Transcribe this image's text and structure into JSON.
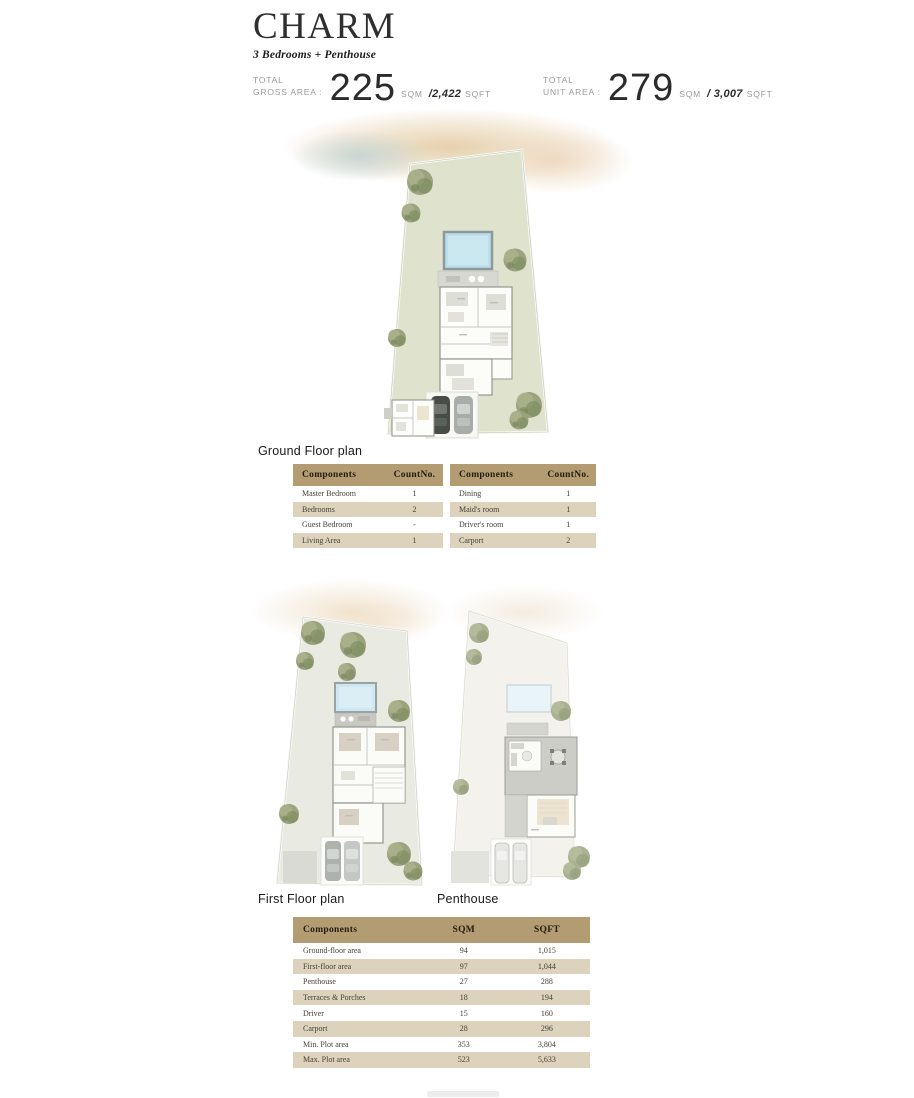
{
  "header": {
    "title": "CHARM",
    "subtitle": "3 Bedrooms + Penthouse"
  },
  "stats": [
    {
      "label_line1": "TOTAL",
      "label_line2": "GROSS AREA :",
      "value": "225",
      "unit1": "SQM",
      "alt": "/2,422",
      "unit2": "SQFT"
    },
    {
      "label_line1": "TOTAL",
      "label_line2": "UNIT AREA :",
      "value": "279",
      "unit1": "SQM",
      "alt": "/ 3,007",
      "unit2": "SQFT"
    }
  ],
  "plans": {
    "ground": {
      "label": "Ground Floor plan"
    },
    "first": {
      "label": "First Floor plan"
    },
    "penthouse": {
      "label": "Penthouse"
    }
  },
  "component_tables": [
    {
      "headers": [
        "Components",
        "CountNo."
      ],
      "rows": [
        [
          "Master Bedroom",
          "1"
        ],
        [
          "Bedrooms",
          "2"
        ],
        [
          "Guest Bedroom",
          "-"
        ],
        [
          "Living Area",
          "1"
        ]
      ]
    },
    {
      "headers": [
        "Components",
        "CountNo."
      ],
      "rows": [
        [
          "Dining",
          "1"
        ],
        [
          "Maid's room",
          "1"
        ],
        [
          "Driver's room",
          "1"
        ],
        [
          "Carport",
          "2"
        ]
      ]
    }
  ],
  "area_table": {
    "headers": [
      "Components",
      "SQM",
      "SQFT"
    ],
    "rows": [
      [
        "Ground-floor area",
        "94",
        "1,015"
      ],
      [
        "First-floor area",
        "97",
        "1,044"
      ],
      [
        "Penthouse",
        "27",
        "288"
      ],
      [
        "Terraces & Porches",
        "18",
        "194"
      ],
      [
        "Driver",
        "15",
        "160"
      ],
      [
        "Carport",
        "28",
        "296"
      ],
      [
        "Min. Plot area",
        "353",
        "3,804"
      ],
      [
        "Max. Plot area",
        "523",
        "5,633"
      ]
    ]
  },
  "colors": {
    "table_header_bg": "#b39c72",
    "table_row_alt_bg": "#ddd2bb",
    "plot_green": "#dfe3cd",
    "plot_gray": "#e9eae1",
    "plot_light": "#f3f2ec",
    "pool_blue": "#bcdfec"
  }
}
